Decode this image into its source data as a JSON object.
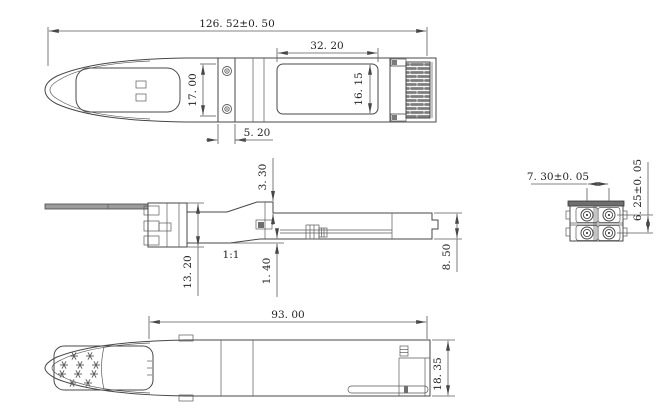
{
  "drawing": {
    "background": "#ffffff",
    "line_color": "#474747",
    "views": {
      "top": {
        "name": "top-view"
      },
      "side": {
        "name": "side-view",
        "scale_label": "1:1"
      },
      "end": {
        "name": "end-view"
      },
      "bottom": {
        "name": "bottom-view"
      }
    },
    "dimensions": {
      "overall_length": "126. 52±0. 50",
      "window_width": "32. 20",
      "top_inner_height": "17. 00",
      "window_height": "16. 15",
      "screw_strip_width": "5. 20",
      "rear_top_offset": "3. 30",
      "front_height": "13. 20",
      "rear_bottom_offset": "1. 40",
      "rear_height": "8. 50",
      "ferrule_pitch_horizontal": "7. 30±0. 05",
      "ferrule_pitch_vertical": "6. 25±0. 05",
      "lower_body_length": "93. 00",
      "body_width": "18. 35"
    }
  }
}
